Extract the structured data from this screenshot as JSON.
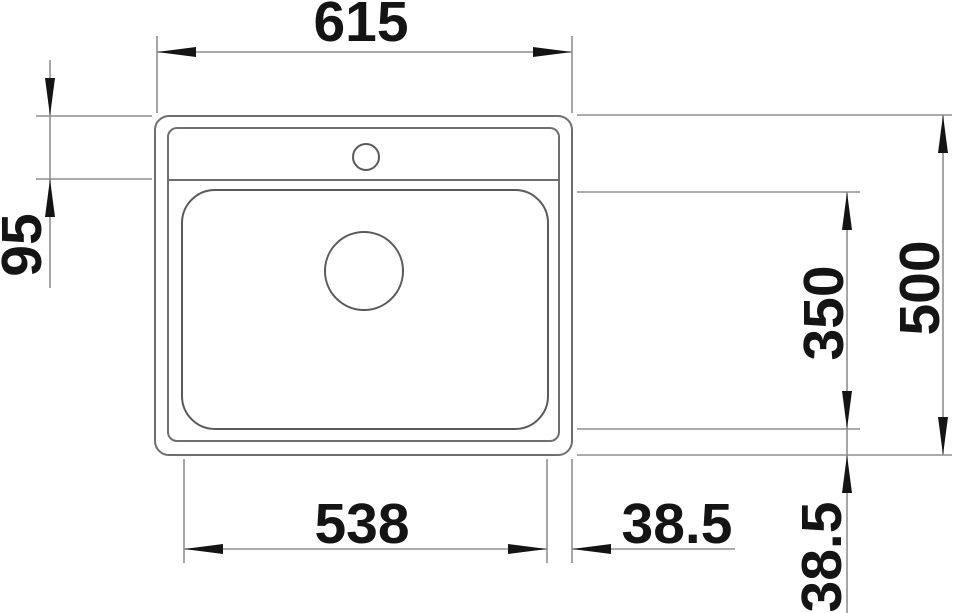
{
  "drawing": {
    "title": "Sink top-view technical dimension drawing",
    "view": "top",
    "dimensions": {
      "overall_width": "615",
      "deck_depth": "95",
      "bowl_depth": "350",
      "overall_depth": "500",
      "bowl_width": "538",
      "edge_offset_horizontal": "38.5",
      "edge_offset_vertical": "38.5"
    },
    "colors": {
      "background": "#ffffff",
      "sink_outline": "#6f6f6f",
      "dimension_lines": "#8f8f8f",
      "arrows_and_text": "#141414"
    }
  }
}
